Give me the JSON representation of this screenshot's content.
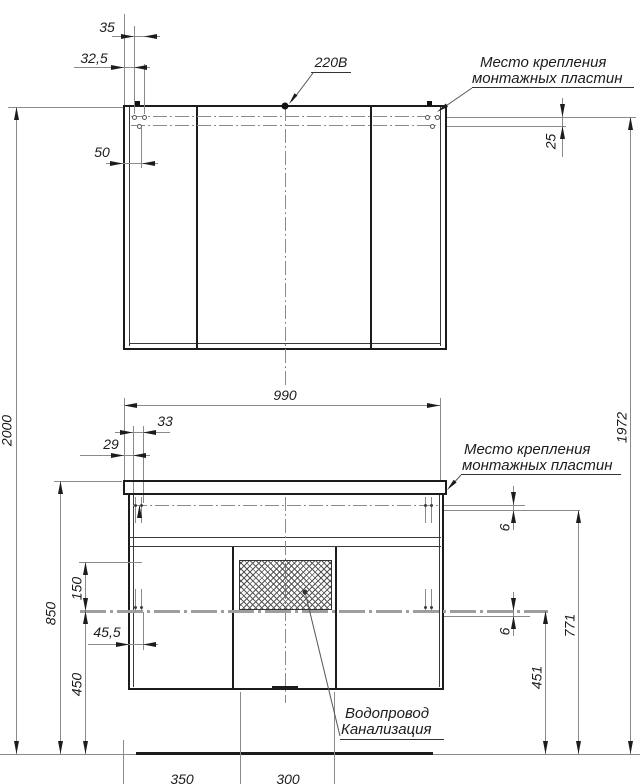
{
  "drawing": {
    "voltage_label": "220В",
    "mount_note_top": {
      "line1": "Место крепления",
      "line2": "монтажных пластин"
    },
    "mount_note_mid": {
      "line1": "Место крепления",
      "line2": "монтажных пластин"
    },
    "plumbing_note": {
      "line1": "Водопровод",
      "line2": "Канализация"
    },
    "dims": {
      "total_height": "2000",
      "mirror_hole_pitch": "35",
      "mirror_hole_offset": "32,5",
      "mirror_side_offset": "50",
      "mirror_row_gap": "25",
      "cabinet_width": "990",
      "vanity_hole_pitch": "33",
      "vanity_hole_offset": "29",
      "counter_height": "850",
      "service_zone_height": "150",
      "vanity_side_offset": "45,5",
      "lower_zone_height": "450",
      "plate_gap_upper": "6",
      "plate_gap_lower": "6",
      "upper_mount_height": "771",
      "lower_mount_height": "451",
      "mirror_mount_height": "1972",
      "floor_span_left": "350",
      "floor_span_center": "300"
    },
    "colors": {
      "outline": "#1c1c1c",
      "dim_line": "#8a8a8a",
      "mount_line": "#9e9e9e"
    }
  }
}
